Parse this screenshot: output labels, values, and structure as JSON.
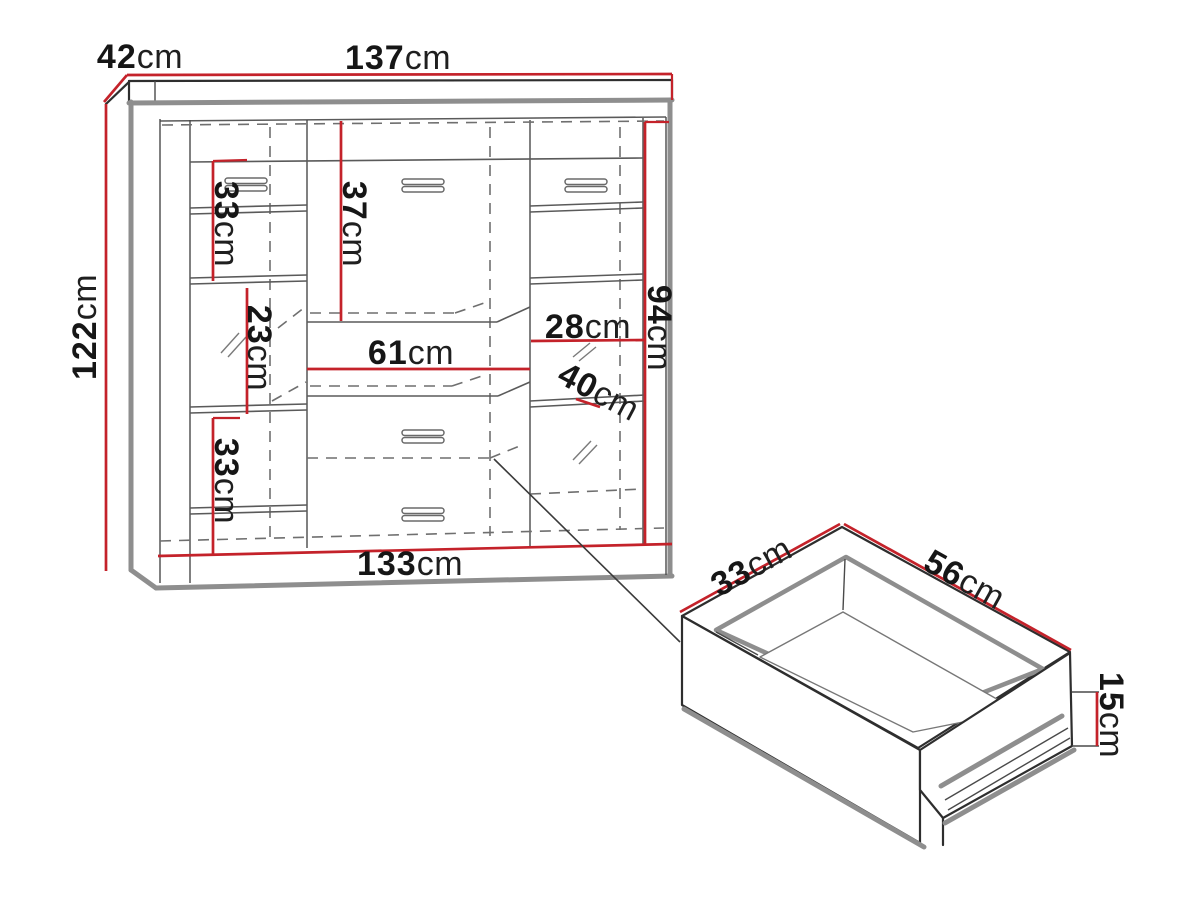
{
  "page": {
    "background": "#ffffff",
    "description": "Furniture dimension diagram: display cabinet front view with drawer detail"
  },
  "colors": {
    "dimension_red": "#c4222a",
    "outline_dark": "#2e2e2e",
    "edge_gray": "#8e8e8e",
    "hidden_line_gray": "#6f6f6f",
    "text_black": "#161616"
  },
  "cabinet": {
    "d137": {
      "num": "137",
      "unit": "cm"
    },
    "d42": {
      "num": "42",
      "unit": "cm"
    },
    "d122": {
      "num": "122",
      "unit": "cm"
    },
    "d33_top": {
      "num": "33",
      "unit": "cm"
    },
    "d37": {
      "num": "37",
      "unit": "cm"
    },
    "d23": {
      "num": "23",
      "unit": "cm"
    },
    "d33_bottom": {
      "num": "33",
      "unit": "cm"
    },
    "d61": {
      "num": "61",
      "unit": "cm"
    },
    "d28": {
      "num": "28",
      "unit": "cm"
    },
    "d40": {
      "num": "40",
      "unit": "cm"
    },
    "d94": {
      "num": "94",
      "unit": "cm"
    },
    "d133": {
      "num": "133",
      "unit": "cm"
    }
  },
  "drawer": {
    "d33": {
      "num": "33",
      "unit": "cm"
    },
    "d56": {
      "num": "56",
      "unit": "cm"
    },
    "d15": {
      "num": "15",
      "unit": "cm"
    }
  }
}
